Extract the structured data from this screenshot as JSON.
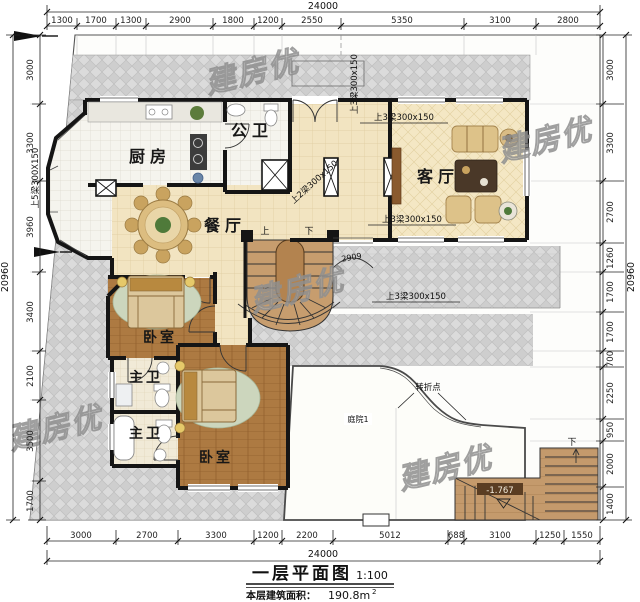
{
  "watermark": {
    "text": "建房优"
  },
  "dims": {
    "top": {
      "overall": "24000",
      "segments": [
        "1300",
        "1700",
        "1300",
        "2900",
        "1800",
        "1200",
        "2550",
        "5350",
        "3100",
        "2800"
      ]
    },
    "bottom": {
      "overall": "24000",
      "segments": [
        "3000",
        "2700",
        "3300",
        "1200",
        "2200",
        "5012",
        "688",
        "3100",
        "1250",
        "1550"
      ]
    },
    "left": {
      "overall": "20960",
      "segments": [
        "3000",
        "3300",
        "3960",
        "3400",
        "2100",
        "3500",
        "1700"
      ]
    },
    "right": {
      "overall": "20960",
      "segments": [
        "3000",
        "3300",
        "2700",
        "1260",
        "1700",
        "1700",
        "700",
        "2250",
        "950",
        "2000",
        "1400"
      ]
    }
  },
  "rooms": {
    "kitchen": "厨房",
    "public_bath": "公卫",
    "living": "客厅",
    "dining": "餐厅",
    "bedroom1": "卧室",
    "master_bath1": "主卫",
    "master_bath2": "主卫",
    "bedroom2": "卧室",
    "courtyard": "庭院1"
  },
  "stairs": {
    "up": "上",
    "down": "下",
    "ext_down": "下"
  },
  "annotations": {
    "beam_top_v": "上3梁300x150",
    "beam_left_v": "上5梁300X150",
    "beam_diag": "上2梁300x150",
    "beam_h1": "上3梁300x150",
    "beam_h2": "上3梁300x150",
    "beam_h3": "上3梁300x150",
    "porch_dim": "2909",
    "turning_point": "转折点",
    "elevation": "-1.767"
  },
  "title": {
    "name": "一层平面图",
    "scale": "1:100",
    "area_label": "本层建筑面积：",
    "area_value": "190.8m",
    "area_sup": "2"
  }
}
